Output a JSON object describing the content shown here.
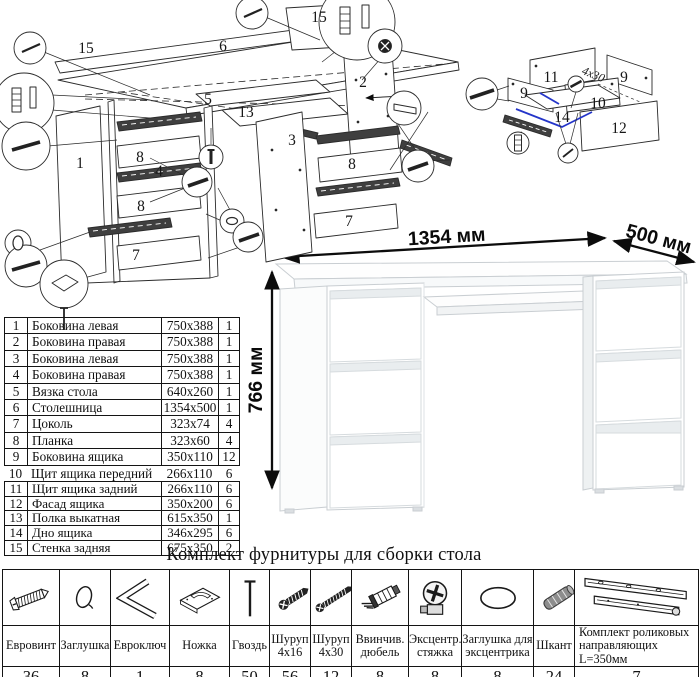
{
  "title": {
    "hardware_kit": "Комплект фурнитуры для сборки стола"
  },
  "desk_dimensions": {
    "width": "1354 мм",
    "depth": "500 мм",
    "height": "766 мм"
  },
  "parts_table": {
    "rows": [
      {
        "num": "1",
        "name": "Боковина левая",
        "size": "750x388",
        "qty": "1"
      },
      {
        "num": "2",
        "name": "Боковина правая",
        "size": "750x388",
        "qty": "1"
      },
      {
        "num": "3",
        "name": "Боковина левая",
        "size": "750x388",
        "qty": "1"
      },
      {
        "num": "4",
        "name": "Боковина правая",
        "size": "750x388",
        "qty": "1"
      },
      {
        "num": "5",
        "name": "Вязка стола",
        "size": "640x260",
        "qty": "1"
      },
      {
        "num": "6",
        "name": "Столешница",
        "size": "1354x500",
        "qty": "1"
      },
      {
        "num": "7",
        "name": "Цоколь",
        "size": "323x74",
        "qty": "4"
      },
      {
        "num": "8",
        "name": "Планка",
        "size": "323x60",
        "qty": "4"
      },
      {
        "num": "9",
        "name": "Боковина ящика",
        "size": "350x110",
        "qty": "12"
      },
      {
        "num": "10",
        "name": "Щит ящика передний",
        "size": "266x110",
        "qty": "6"
      },
      {
        "num": "11",
        "name": "Щит ящика задний",
        "size": "266x110",
        "qty": "6"
      },
      {
        "num": "12",
        "name": "Фасад ящика",
        "size": "350x200",
        "qty": "6"
      },
      {
        "num": "13",
        "name": "Полка выкатная",
        "size": "615x350",
        "qty": "1"
      },
      {
        "num": "14",
        "name": "Дно ящика",
        "size": "346x295",
        "qty": "6"
      },
      {
        "num": "15",
        "name": "Стенка задняя",
        "size": "675x350",
        "qty": "2"
      }
    ]
  },
  "hardware_table": {
    "columns": [
      {
        "icon": "eurovint-icon",
        "name": "Евровинт",
        "qty": "36"
      },
      {
        "icon": "cap-icon",
        "name": "Заглушка",
        "qty": "8"
      },
      {
        "icon": "hex-key-icon",
        "name": "Евроключ",
        "qty": "1"
      },
      {
        "icon": "foot-icon",
        "name": "Ножка",
        "qty": "8"
      },
      {
        "icon": "nail-icon",
        "name": "Гвоздь",
        "qty": "50"
      },
      {
        "icon": "screw-short-icon",
        "name": "Шуруп 4x16",
        "qty": "56"
      },
      {
        "icon": "screw-long-icon",
        "name": "Шуруп 4x30",
        "qty": "12"
      },
      {
        "icon": "dowel-screw-icon",
        "name": "Ввинчив. дюбель",
        "qty": "8"
      },
      {
        "icon": "cam-lock-icon",
        "name": "Эксцентр. стяжка",
        "qty": "8"
      },
      {
        "icon": "cam-cap-icon",
        "name": "Заглушка для эксцентрика",
        "qty": "8"
      },
      {
        "icon": "wood-dowel-icon",
        "name": "Шкант",
        "qty": "24"
      },
      {
        "icon": "drawer-slide-icon",
        "name": "Комплект роликовых направляющих L=350мм",
        "qty": "7"
      }
    ]
  },
  "diagram_labels": {
    "numbers": [
      {
        "t": "15",
        "x": 86,
        "y": 53
      },
      {
        "t": "6",
        "x": 223,
        "y": 51
      },
      {
        "t": "15",
        "x": 319,
        "y": 22
      },
      {
        "t": "2",
        "x": 363,
        "y": 87
      },
      {
        "t": "5",
        "x": 208,
        "y": 104
      },
      {
        "t": "13",
        "x": 246,
        "y": 117
      },
      {
        "t": "3",
        "x": 292,
        "y": 145
      },
      {
        "t": "8",
        "x": 140,
        "y": 162
      },
      {
        "t": "4",
        "x": 159,
        "y": 176
      },
      {
        "t": "8",
        "x": 141,
        "y": 211
      },
      {
        "t": "7",
        "x": 136,
        "y": 260
      },
      {
        "t": "1",
        "x": 80,
        "y": 168
      },
      {
        "t": "8",
        "x": 352,
        "y": 169
      },
      {
        "t": "7",
        "x": 349,
        "y": 226
      },
      {
        "t": "11",
        "x": 551,
        "y": 82
      },
      {
        "t": "9",
        "x": 524,
        "y": 98
      },
      {
        "t": "9",
        "x": 624,
        "y": 82
      },
      {
        "t": "10",
        "x": 598,
        "y": 108
      },
      {
        "t": "14",
        "x": 562,
        "y": 122
      },
      {
        "t": "12",
        "x": 619,
        "y": 133
      }
    ],
    "screw_note": {
      "t": "4x30",
      "x": 592,
      "y": 78,
      "rot": 22
    },
    "dimensions": [
      {
        "t": "1354 мм",
        "x": 447,
        "y": 243,
        "rot": -3.5
      },
      {
        "t": "500 мм",
        "x": 657,
        "y": 245,
        "rot": 15
      },
      {
        "t": "766 мм",
        "x": 262,
        "y": 380,
        "rot": -90
      }
    ]
  }
}
